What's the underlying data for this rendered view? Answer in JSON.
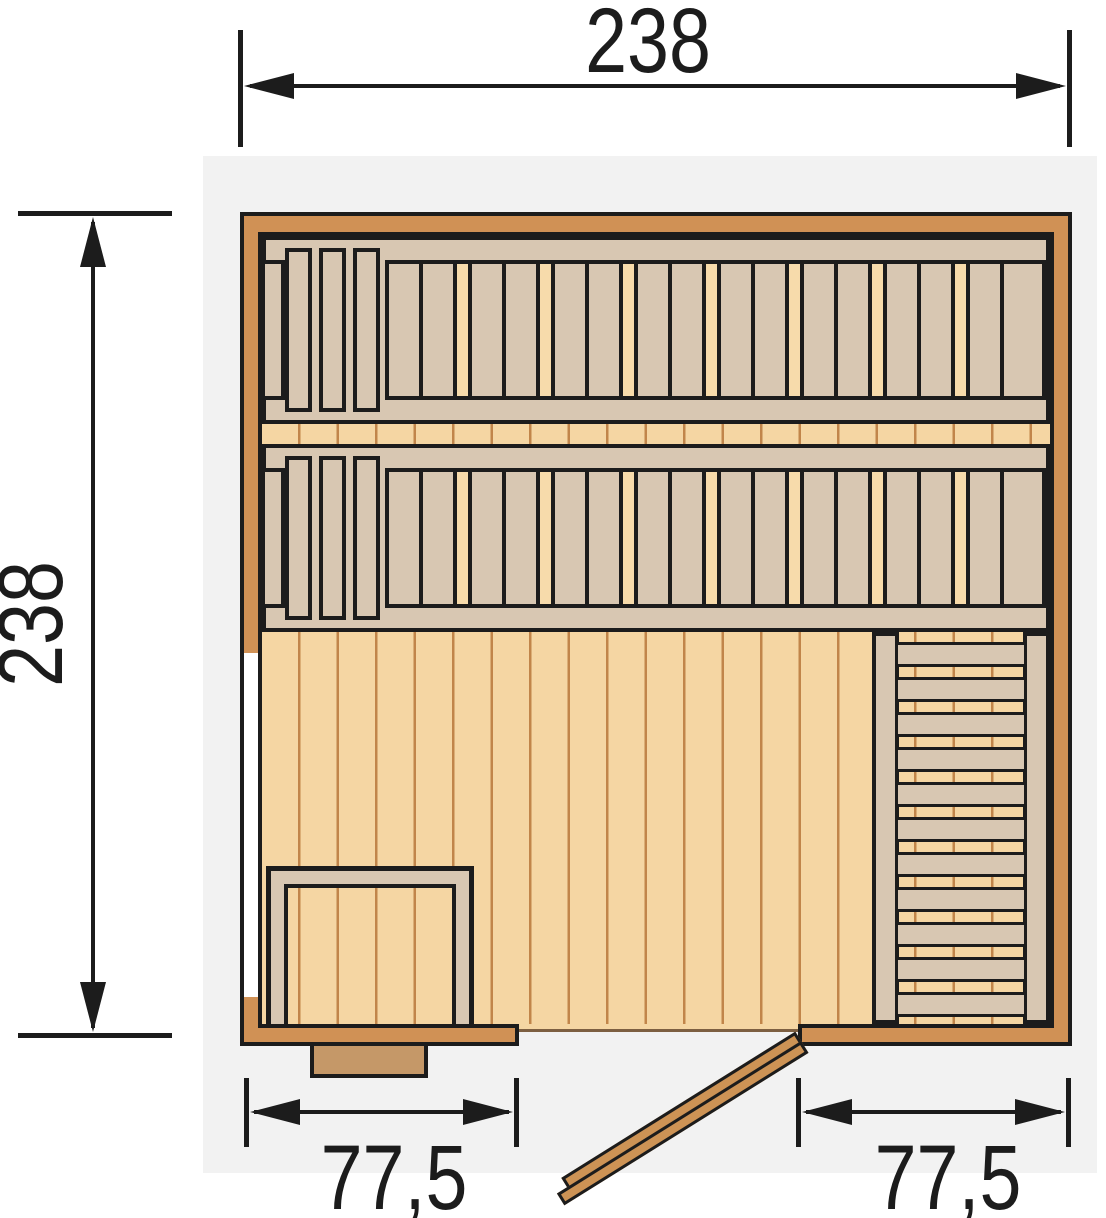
{
  "figure": {
    "type": "floor-plan",
    "subject": "sauna-top-view"
  },
  "dimension_labels": {
    "top": "238",
    "left": "238",
    "bottom_left": "77,5",
    "bottom_right": "77,5"
  },
  "colors": {
    "canvas_bg": "#ffffff",
    "plan_bg": "#f2f2f2",
    "line": "#1c1c1c",
    "wall": "#d09155",
    "bench": "#d8c7b2",
    "floor": "#f5d6a3",
    "floor_light": "#f7dbab",
    "plank_line": "#c1854a",
    "door": "#cd9355",
    "step": "#c59868",
    "threshold": "#7d5f41",
    "window": "#ffffff"
  },
  "layout_hints": {
    "bench_rows": 2,
    "headrest_boards_per_row": 3,
    "right_bench_boards": 11
  }
}
